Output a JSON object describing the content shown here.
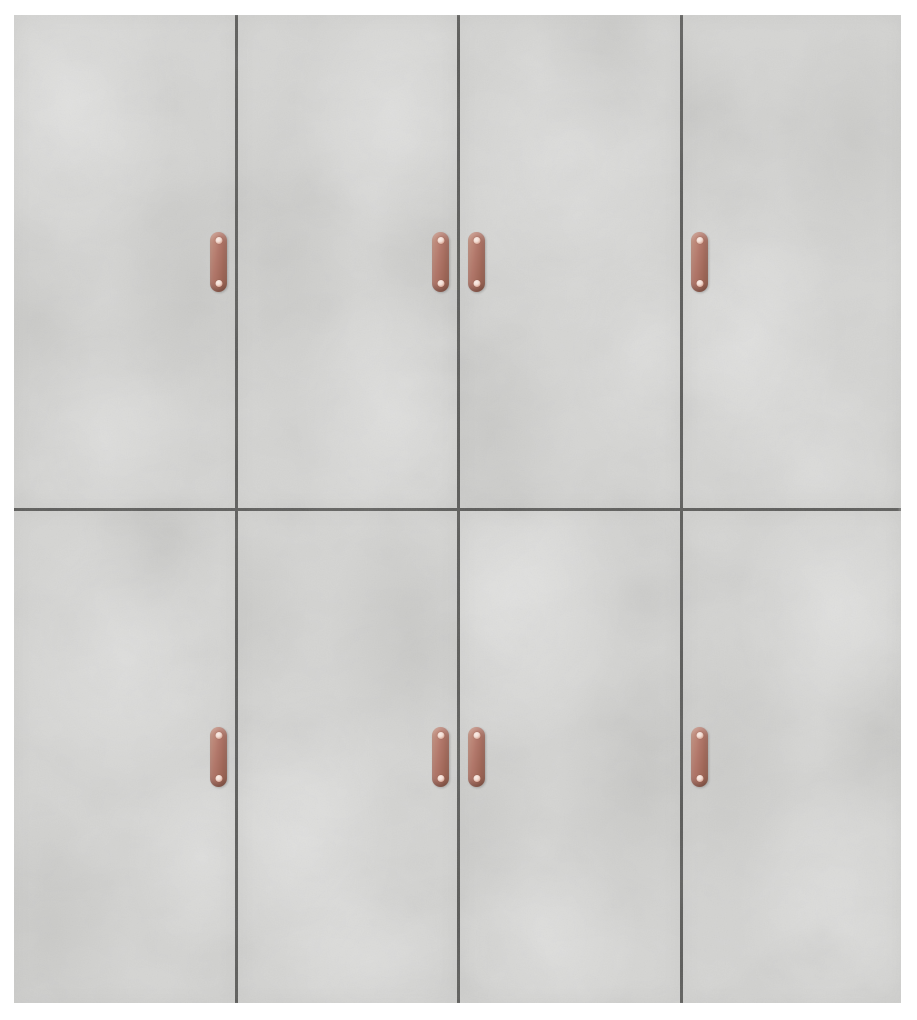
{
  "scene": {
    "type": "product-photograph",
    "description": "Wall cabinet with eight concrete-grey doors arranged in 4 columns and 2 rows, each door with a vertical copper pull handle; handles are paired toward the inner seams, photographed on a plain white background",
    "background_color": "#ffffff"
  },
  "cabinet": {
    "finish": "concrete grey",
    "rows": 2,
    "columns": 4,
    "door_count": 8,
    "handle_count": 8,
    "colors": {
      "background": "#ffffff",
      "door_base": "#d5d5d3",
      "door_light_patch": "#e4e4e2",
      "door_dark_patch": "#c2c2c0",
      "seam": "#595957",
      "handle_main": "#b1776a",
      "handle_light": "#cb9a88",
      "handle_dark": "#8e5847",
      "screw": "#f2ddd4"
    },
    "doors": [
      {
        "row": 1,
        "column": 1,
        "handle_side": "right"
      },
      {
        "row": 1,
        "column": 2,
        "handle_side": "right"
      },
      {
        "row": 1,
        "column": 3,
        "handle_side": "left"
      },
      {
        "row": 1,
        "column": 4,
        "handle_side": "left"
      },
      {
        "row": 2,
        "column": 1,
        "handle_side": "right"
      },
      {
        "row": 2,
        "column": 2,
        "handle_side": "right"
      },
      {
        "row": 2,
        "column": 3,
        "handle_side": "left"
      },
      {
        "row": 2,
        "column": 4,
        "handle_side": "left"
      }
    ]
  }
}
